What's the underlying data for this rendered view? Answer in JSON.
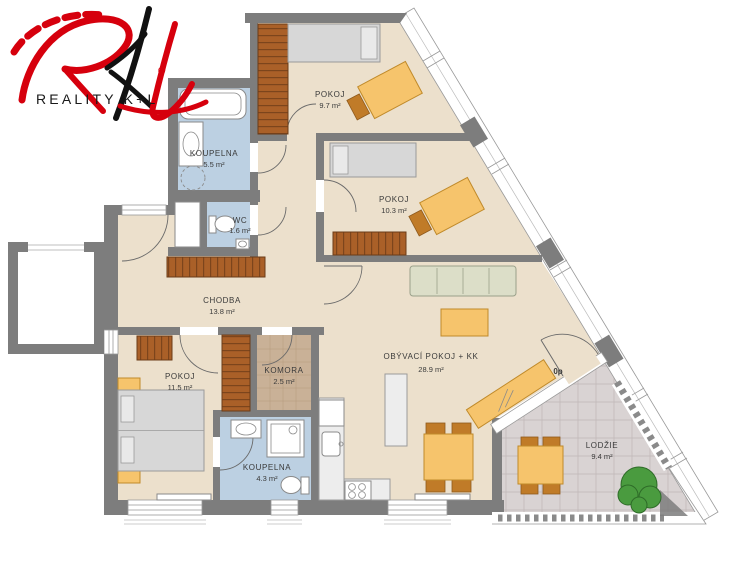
{
  "logo": {
    "brand": "REALITY K+L",
    "registered": "®"
  },
  "rooms": {
    "pokoj_top": {
      "name": "POKOJ",
      "area": "9.7 m²"
    },
    "pokoj_mid": {
      "name": "POKOJ",
      "area": "10.3 m²"
    },
    "koupelna_top": {
      "name": "KOUPELNA",
      "area": "5.5 m²"
    },
    "wc": {
      "name": "WC",
      "area": "1.6 m²"
    },
    "chodba": {
      "name": "CHODBA",
      "area": "13.8 m²"
    },
    "pokoj_bottom": {
      "name": "POKOJ",
      "area": "11.5 m²"
    },
    "komora": {
      "name": "KOMORA",
      "area": "2.5 m²"
    },
    "koupelna_bottom": {
      "name": "KOUPELNA",
      "area": "4.3 m²"
    },
    "obyvaci": {
      "name": "OBÝVACÍ POKOJ + KK",
      "area": "28.9 m²"
    },
    "lodzie": {
      "name": "LODŽIE",
      "area": "9.4 m²"
    }
  },
  "annotations": {
    "floor_marker": "0p"
  },
  "colors": {
    "wall": "#7d7d7d",
    "floor": "#ece0cc",
    "bath": "#bcd0e2",
    "komora_floor": "#c9b197",
    "loggia_floor": "#d9d3d3",
    "wood": "#aa6028",
    "furniture": "#f6c46c",
    "tree": "#4a9b3f",
    "logo_red": "#d6000d",
    "logo_black": "#111111"
  }
}
